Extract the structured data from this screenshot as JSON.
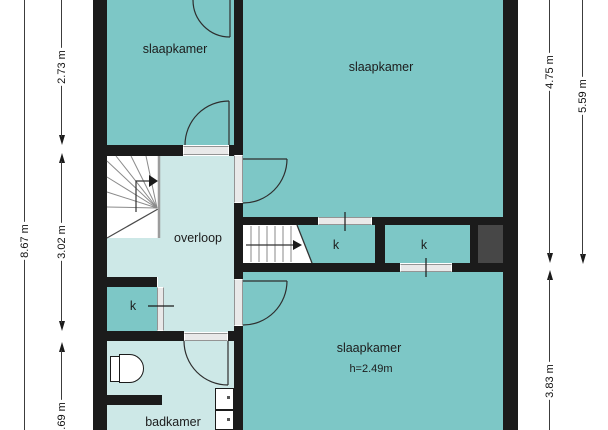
{
  "plan": {
    "rooms": {
      "bedroom_top_left": {
        "label": "slaapkamer"
      },
      "bedroom_top_right": {
        "label": "slaapkamer"
      },
      "bedroom_bottom": {
        "label": "slaapkamer",
        "height_note": "h=2.49m"
      },
      "landing": {
        "label": "overloop"
      },
      "bathroom": {
        "label": "badkamer"
      },
      "closet_left": {
        "label": "k"
      },
      "closet_mid": {
        "label": "k"
      },
      "closet_right": {
        "label": "k"
      }
    },
    "dimensions": {
      "left_outer": "8.67 m",
      "left_top": "2.73 m",
      "left_middle": "3.02 m",
      "left_bottom": "1.69 m",
      "right_inner_top": "4.75 m",
      "right_inner_bottom": "3.83 m",
      "right_outer": "5.59 m"
    },
    "colors": {
      "room_fill": "#7dc7c6",
      "hall_fill": "#cde8e7",
      "wall": "#1b1b1b",
      "shaft_fill": "#474747",
      "opening_fill": "#e9e9e9"
    }
  }
}
